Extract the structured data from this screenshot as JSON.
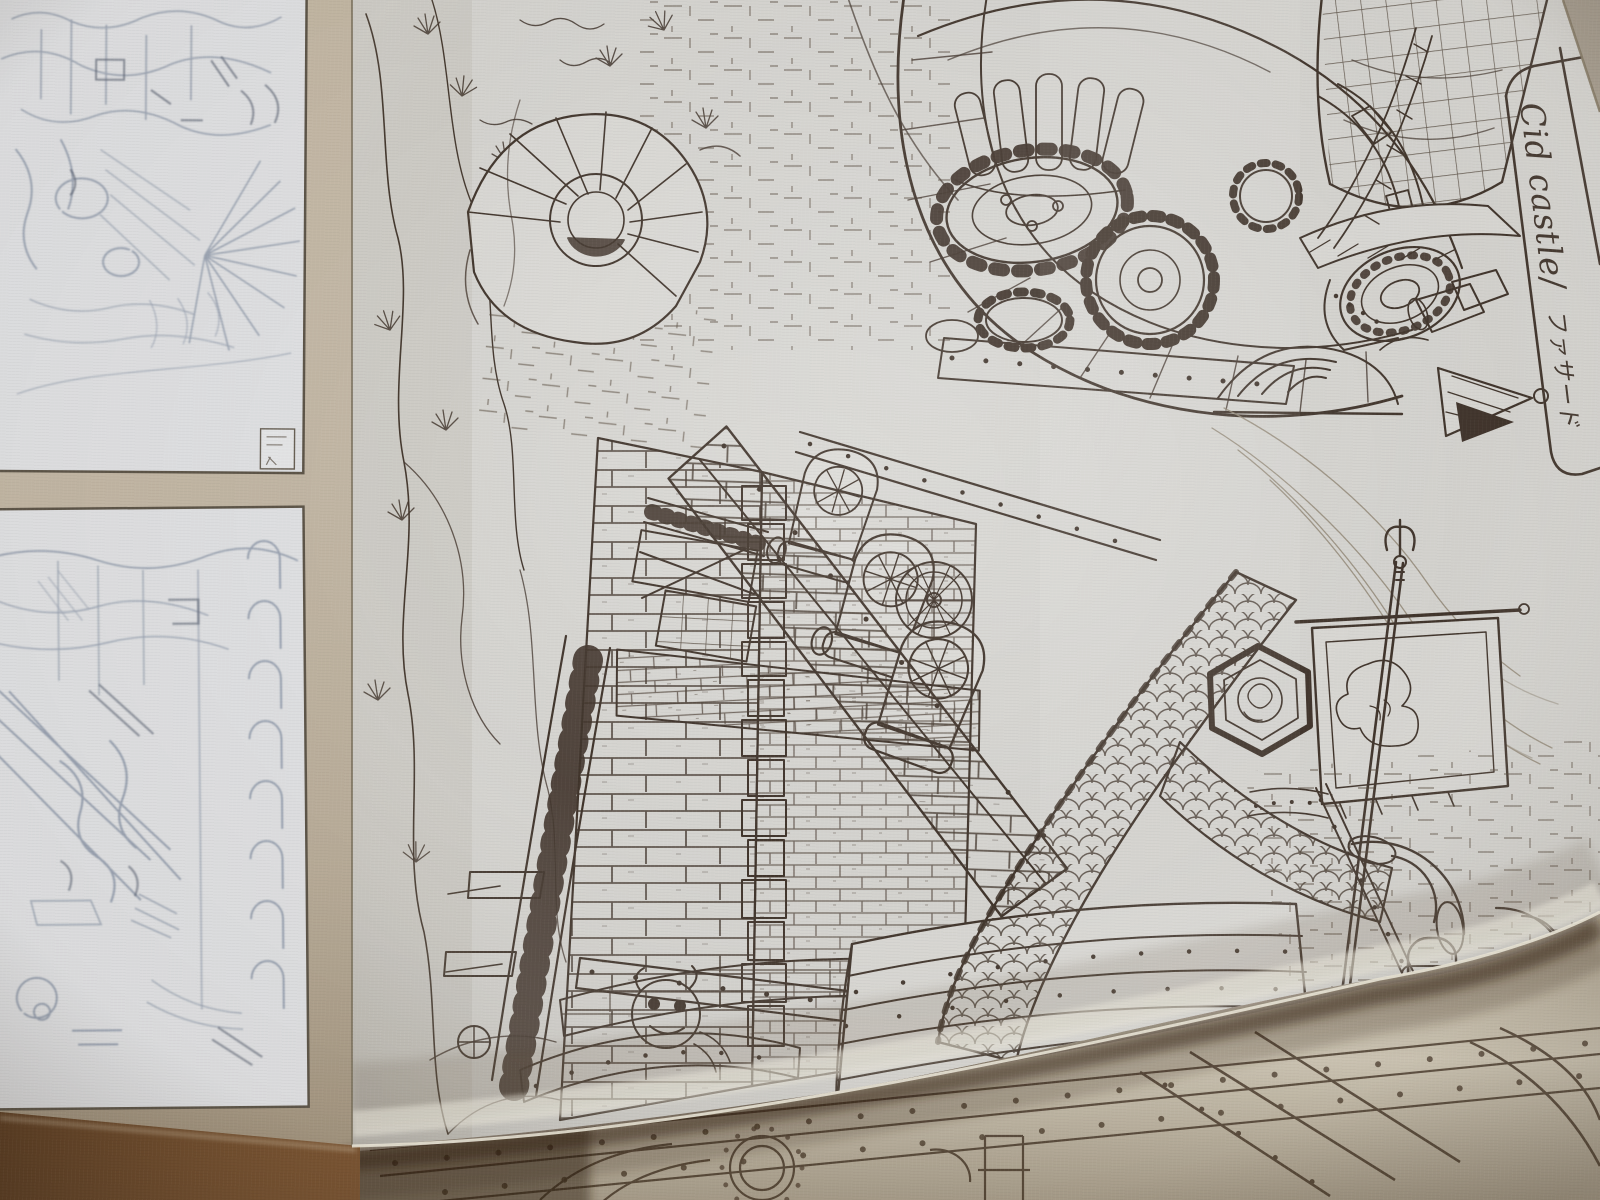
{
  "label": {
    "line1": "Cid castle/",
    "line2": "ファサード"
  },
  "palette": {
    "left_page_tan": "#c6baa7",
    "sketch_paper": "#e3e4e6",
    "pencil_gray": "#8f9aab",
    "main_paper": "#d9d8d4",
    "ink": "#42362d",
    "faint_ink": "#93897a",
    "under_page_paper": "#d9d2c1",
    "book_shadow_brown": "#754f2f"
  }
}
